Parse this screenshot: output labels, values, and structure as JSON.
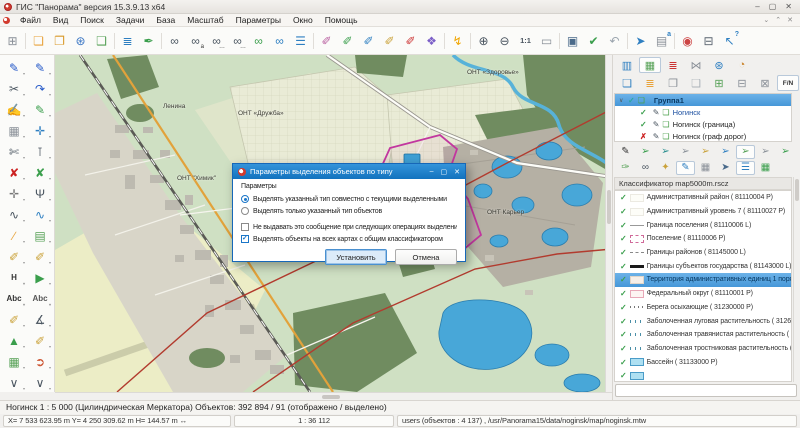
{
  "window": {
    "title": "ГИС \"Панорама\" версия 15.3.9.13 x64",
    "controls": {
      "minimize": "‒",
      "maximize": "▢",
      "close": "✕"
    },
    "mdi_controls": {
      "restore_down": "⌄",
      "restore_up": "⌃",
      "close": "✕"
    }
  },
  "menu": {
    "items": [
      {
        "label": "Файл"
      },
      {
        "label": "Вид"
      },
      {
        "label": "Поиск"
      },
      {
        "label": "Задачи"
      },
      {
        "label": "База"
      },
      {
        "label": "Масштаб"
      },
      {
        "label": "Параметры"
      },
      {
        "label": "Окно"
      },
      {
        "label": "Помощь"
      }
    ]
  },
  "main_toolbar": {
    "icons": [
      {
        "name": "new-map-icon",
        "glyph": "⊞",
        "color": "#8a9098"
      },
      {
        "name": "separator",
        "cls": "sep",
        "inter": "false"
      },
      {
        "name": "open-map-icon",
        "glyph": "❏",
        "color": "#e8a33c"
      },
      {
        "name": "open-database-icon",
        "glyph": "❐",
        "color": "#d99a2b"
      },
      {
        "name": "open-geoportal-icon",
        "glyph": "⊛",
        "color": "#3a76c4"
      },
      {
        "name": "open-internet-map-icon",
        "glyph": "❑",
        "color": "#56a156"
      },
      {
        "name": "separator",
        "cls": "sep",
        "inter": "false"
      },
      {
        "name": "map-layers-icon",
        "glyph": "≣",
        "color": "#2e7fc1"
      },
      {
        "name": "map-legend-icon",
        "glyph": "✒",
        "color": "#3a9e4c"
      },
      {
        "name": "separator",
        "cls": "sep",
        "inter": "false"
      },
      {
        "name": "search-icon",
        "glyph": "∞",
        "color": "#4a5560"
      },
      {
        "name": "search-by-name-icon",
        "glyph": "∞",
        "color": "#4a5560",
        "sub": "a"
      },
      {
        "name": "search-sequential-icon",
        "glyph": "∞",
        "color": "#4a5560",
        "sub": "…"
      },
      {
        "name": "search-repeat-icon",
        "glyph": "∞",
        "color": "#4a5560",
        "sub": "…"
      },
      {
        "name": "search-in-area-icon",
        "glyph": "∞",
        "color": "#3a9e4c"
      },
      {
        "name": "search-on-globe-icon",
        "glyph": "∞",
        "color": "#2e7fc1"
      },
      {
        "name": "search-list-icon",
        "glyph": "☰",
        "color": "#2e7fc1"
      },
      {
        "name": "separator",
        "cls": "sep",
        "inter": "false"
      },
      {
        "name": "select-by-type-icon",
        "glyph": "✐",
        "color": "#b85fa0"
      },
      {
        "name": "select-apply-icon",
        "glyph": "✐",
        "color": "#3a9e4c"
      },
      {
        "name": "select-add-icon",
        "glyph": "✐",
        "color": "#2e7fc1"
      },
      {
        "name": "select-by-frame-icon",
        "glyph": "✐",
        "color": "#caa23a"
      },
      {
        "name": "select-clear-icon",
        "glyph": "✐",
        "color": "#cc3333"
      },
      {
        "name": "select-shapes-icon",
        "glyph": "❖",
        "color": "#7b5ec7"
      },
      {
        "name": "separator",
        "cls": "sep",
        "inter": "false"
      },
      {
        "name": "fast-launch-icon",
        "glyph": "↯",
        "color": "#f0a500"
      },
      {
        "name": "separator",
        "cls": "sep",
        "inter": "false"
      },
      {
        "name": "zoom-in-icon",
        "glyph": "⊕",
        "color": "#4a5560"
      },
      {
        "name": "zoom-out-icon",
        "glyph": "⊖",
        "color": "#4a5560"
      },
      {
        "name": "scale-1-1-icon",
        "glyph": "1:1",
        "color": "#4a5560",
        "cls": "txt"
      },
      {
        "name": "fit-extent-icon",
        "glyph": "▭",
        "color": "#8a9098"
      },
      {
        "name": "separator",
        "cls": "sep",
        "inter": "false"
      },
      {
        "name": "screen-area-icon",
        "glyph": "▣",
        "color": "#4a6a8a"
      },
      {
        "name": "apply-check-icon",
        "glyph": "✔",
        "color": "#3a9e4c"
      },
      {
        "name": "undo-selection-icon",
        "glyph": "↶",
        "color": "#9aa4ad"
      },
      {
        "name": "separator",
        "cls": "sep",
        "inter": "false"
      },
      {
        "name": "select-pointer-icon",
        "glyph": "➤",
        "color": "#2e7fc1"
      },
      {
        "name": "object-card-icon",
        "glyph": "▤",
        "color": "#8a9098",
        "sup": "a"
      },
      {
        "name": "separator",
        "cls": "sep",
        "inter": "false"
      },
      {
        "name": "palette-icon",
        "glyph": "◉",
        "color": "#cc4444"
      },
      {
        "name": "print-icon",
        "glyph": "⊟",
        "color": "#5a6470"
      },
      {
        "name": "help-pointer-icon",
        "glyph": "↖",
        "color": "#2e7fc1",
        "sup": "?"
      }
    ]
  },
  "left_toolbar": {
    "icons": [
      {
        "name": "create-object-icon",
        "glyph": "✎",
        "color": "#2458c8"
      },
      {
        "name": "edit-object-icon",
        "glyph": "✎",
        "color": "#2458c8"
      },
      {
        "name": "cut-object-icon",
        "glyph": "✂",
        "color": "#4a5560"
      },
      {
        "name": "edit-curve-icon",
        "glyph": "↷",
        "color": "#2458c8"
      },
      {
        "name": "edit-query-icon",
        "glyph": "✍",
        "color": "#2458c8"
      },
      {
        "name": "edit-apply-icon",
        "glyph": "✎",
        "color": "#3a9e4c"
      },
      {
        "name": "stamp-icon",
        "glyph": "▦",
        "color": "#8a9098"
      },
      {
        "name": "move-object-icon",
        "glyph": "✛",
        "color": "#2e7fc1"
      },
      {
        "name": "split-icon",
        "glyph": "✄",
        "color": "#4a5560"
      },
      {
        "name": "align-icon",
        "glyph": "⊺",
        "color": "#4a5560"
      },
      {
        "name": "delete-object-icon",
        "glyph": "✘",
        "color": "#cc2222"
      },
      {
        "name": "delete-part-icon",
        "glyph": "✘",
        "color": "#3a9e4c"
      },
      {
        "name": "edit-node-icon",
        "glyph": "✛",
        "color": "#777777"
      },
      {
        "name": "topology-icon",
        "glyph": "Ψ",
        "color": "#4a5560"
      },
      {
        "name": "smooth-line-icon",
        "glyph": "∿",
        "color": "#4a5560"
      },
      {
        "name": "spline-icon",
        "glyph": "∿",
        "color": "#2e7fc1"
      },
      {
        "name": "ruler-icon",
        "glyph": "∕",
        "color": "#e8a33c"
      },
      {
        "name": "area-calc-icon",
        "glyph": "▤",
        "color": "#56a156"
      },
      {
        "name": "highlight-a-icon",
        "glyph": "✐",
        "color": "#caa23a",
        "sub": "a"
      },
      {
        "name": "highlight-grid-icon",
        "glyph": "✐",
        "color": "#caa23a"
      },
      {
        "name": "height-icon",
        "glyph": "H",
        "color": "#333333",
        "cls": "txt"
      },
      {
        "name": "run-icon",
        "glyph": "▶",
        "color": "#3a9e4c"
      },
      {
        "name": "text-abc-icon",
        "glyph": "Abc",
        "color": "#333333",
        "cls": "txt"
      },
      {
        "name": "text-abc2-icon",
        "glyph": "Abc",
        "color": "#555555",
        "cls": "txt"
      },
      {
        "name": "flashlight-icon",
        "glyph": "✐",
        "color": "#caa23a"
      },
      {
        "name": "angle-measure-icon",
        "glyph": "∡",
        "color": "#4a5560"
      },
      {
        "name": "tin-model-icon",
        "glyph": "▲",
        "color": "#3a9e4c"
      },
      {
        "name": "flashlight-grid2-icon",
        "glyph": "✐",
        "color": "#caa23a"
      },
      {
        "name": "calc-table-icon",
        "glyph": "▦",
        "color": "#56a156"
      },
      {
        "name": "route-icon",
        "glyph": "➲",
        "color": "#cc5533"
      },
      {
        "name": "more-tools-left-icon",
        "glyph": "∨",
        "color": "#4a5560"
      },
      {
        "name": "more-tools-right-icon",
        "glyph": "∨",
        "color": "#4a5560"
      }
    ]
  },
  "map": {
    "labels": [
      {
        "text": "Ленина",
        "x": 108,
        "y": 48
      },
      {
        "text": "ОНТ «Дружба»",
        "x": 183,
        "y": 55
      },
      {
        "text": "ОНТ «Здоровье»",
        "x": 412,
        "y": 14
      },
      {
        "text": "ОНТ \"Химик\"",
        "x": 122,
        "y": 120
      },
      {
        "text": "ОНТ Карьер",
        "x": 432,
        "y": 154
      }
    ]
  },
  "dialog": {
    "title": "Параметры выделения объектов по типу",
    "controls": {
      "minimize": "‒",
      "maximize": "▢",
      "close": "✕"
    },
    "group_label": "Параметры",
    "radios": [
      {
        "label": "Выделять указанный тип совместно с текущими выделенными",
        "cls": "checked"
      },
      {
        "label": "Выделять только указанный тип объектов"
      }
    ],
    "checkboxes": [
      {
        "label": "Не выдавать это сообщение при следующих операциях выделения по типу"
      },
      {
        "label": "Выделять объекты на всех картах с общим классификатором",
        "cls": "checked"
      }
    ],
    "buttons": {
      "ok": "Установить",
      "cancel": "Отмена"
    }
  },
  "right_panel": {
    "tabs": [
      {
        "name": "tab-data-list",
        "glyph": "▥",
        "color": "#2e7fc1"
      },
      {
        "name": "tab-map-composition",
        "glyph": "▦",
        "color": "#56a156",
        "cls": "pressed"
      },
      {
        "name": "tab-layers",
        "glyph": "≣",
        "color": "#cc3333"
      },
      {
        "name": "tab-routes",
        "glyph": "⋈",
        "color": "#8a9098"
      },
      {
        "name": "tab-geoportal",
        "glyph": "⊛",
        "color": "#2e7fc1"
      },
      {
        "name": "tab-thematic",
        "glyph": "◔",
        "color": "#cc8833"
      }
    ],
    "tools": [
      {
        "name": "add-data-icon",
        "glyph": "❏",
        "color": "#2e7fc1"
      },
      {
        "name": "add-layer-icon",
        "glyph": "≣",
        "color": "#e8a33c"
      },
      {
        "name": "new-document-icon",
        "glyph": "❐",
        "color": "#8a9098"
      },
      {
        "name": "empty-document-icon",
        "glyph": "❑",
        "color": "#aab2b8"
      },
      {
        "name": "add-table-icon",
        "glyph": "⊞",
        "color": "#56a156"
      },
      {
        "name": "db-export-icon",
        "glyph": "⊟",
        "color": "#8a9098"
      },
      {
        "name": "db-import-icon",
        "glyph": "⊠",
        "color": "#8a9098"
      },
      {
        "name": "fn-toggle",
        "glyph": "F/N",
        "color": "#333333",
        "cls": "pressed txt"
      }
    ],
    "tree": [
      {
        "exp": "∨",
        "mark": "✓",
        "color": "#2aa7a0",
        "folder": "❏",
        "label": "Группа1",
        "cls": "selected"
      },
      {
        "mark": "✓",
        "color": "#3a9e4c",
        "pencil": "✎",
        "maplayer": "❏",
        "label": "Ногинск",
        "indent": 1,
        "labelColor": "#1b4fa0"
      },
      {
        "mark": "✓",
        "color": "#3a9e4c",
        "pencil": "✎",
        "maplayer": "❏",
        "label": "Ногинск (граница)",
        "indent": 1
      },
      {
        "mark": "✗",
        "color": "#cc2222",
        "pencil": "✎",
        "maplayer": "❏",
        "label": "Ногинск (граф дорог)",
        "indent": 1
      }
    ],
    "tools_rowA": [
      {
        "name": "edit-sign-icon",
        "glyph": "✎",
        "color": "#333333"
      },
      {
        "name": "select-stamp-green-icon",
        "glyph": "➢",
        "color": "#3a9e4c"
      },
      {
        "name": "select-stamp-teal-icon",
        "glyph": "➢",
        "color": "#2a8f8f"
      },
      {
        "name": "select-stamp-gray-icon",
        "glyph": "➢",
        "color": "#8a9098"
      },
      {
        "name": "select-stamp-yellow-icon",
        "glyph": "➢",
        "color": "#caa23a"
      },
      {
        "name": "select-stamp-blue-icon",
        "glyph": "➢",
        "color": "#2e7fc1"
      },
      {
        "name": "select-stamp-active-icon",
        "glyph": "➢",
        "color": "#56a156",
        "cls": "pressed"
      },
      {
        "name": "select-stamp-gray2-icon",
        "glyph": "➢",
        "color": "#8a9098"
      },
      {
        "name": "select-stamp-green2-icon",
        "glyph": "➢",
        "color": "#3a9e4c"
      }
    ],
    "tools_rowB": [
      {
        "name": "brush-icon",
        "glyph": "✑",
        "color": "#56a156"
      },
      {
        "name": "find-type-icon",
        "glyph": "∞",
        "color": "#4a5560"
      },
      {
        "name": "wand-icon",
        "glyph": "✦",
        "color": "#caa23a"
      },
      {
        "name": "edit-type-icon",
        "glyph": "✎",
        "color": "#2e7fc1",
        "cls": "pressed"
      },
      {
        "name": "table-view-icon",
        "glyph": "▦",
        "color": "#8a9098"
      },
      {
        "name": "pointer-mode-icon",
        "glyph": "➤",
        "color": "#4a6a8a"
      },
      {
        "name": "list-view-icon",
        "glyph": "☰",
        "color": "#2e7fc1",
        "cls": "pressed"
      },
      {
        "name": "grid-view-icon",
        "glyph": "▦",
        "color": "#3a9e4c"
      }
    ],
    "classifier": {
      "header": "Классификатор map5000m.rscz",
      "items": [
        {
          "label": "Административный район ( 81110004 P)",
          "sym": "sym-blank"
        },
        {
          "label": "Административный уровень 7 ( 81110027 P)",
          "sym": "sym-blank"
        },
        {
          "label": "Граница поселения ( 81110006 L)",
          "sym": "sym-line-thin"
        },
        {
          "label": "Поселение ( 81110006 P)",
          "sym": "sym-rect-dash"
        },
        {
          "label": "Границы районов ( 81145000 L)",
          "sym": "sym-line-dash"
        },
        {
          "label": "Границы субъектов государства ( 81143000 L)",
          "sym": "sym-line-thick"
        },
        {
          "label": "Территория административных единиц 1 поряд...",
          "sym": "sym-rect-pale",
          "cls": "selected"
        },
        {
          "label": "Федеральный округ ( 81110001 P)",
          "sym": "sym-rect-pink"
        },
        {
          "label": "Берега осыхающие ( 31230000 P)",
          "sym": "sym-dots"
        },
        {
          "label": "Заболоченная луговая растительность ( 312634...",
          "sym": "sym-marsh"
        },
        {
          "label": "Заболоченная травянистая растительность ( 31...",
          "sym": "sym-marsh"
        },
        {
          "label": "Заболоченная тростниковая растительность ( 3...",
          "sym": "sym-marsh"
        },
        {
          "label": "Бассейн ( 31133000 P)",
          "sym": "sym-rect-blue"
        },
        {
          "label": "",
          "sym": "sym-rect-blue"
        }
      ]
    },
    "search_value": ""
  },
  "status_bar": {
    "line1": "Ногинск  1 : 5 000 (Цилиндрическая Меркатора) Объектов: 392 894 / 91 (отображено / выделено)",
    "coords": "X= 7 533 623.95 m  Y= 4 250 309.62 m  H=  144.57 m  ↔",
    "scale": "1 : 36 112",
    "right": "users   (объектов : 4 137) , /usr/Panorama15/data/noginsk/map/noginsk.mtw"
  },
  "colors": {
    "accent_blue": "#1b76c8",
    "selection_blue": "#4697d8",
    "map_boundary_red": "#b23b2e",
    "map_selection_magenta": "#c2379f",
    "water_blue": "#48a7d8"
  }
}
